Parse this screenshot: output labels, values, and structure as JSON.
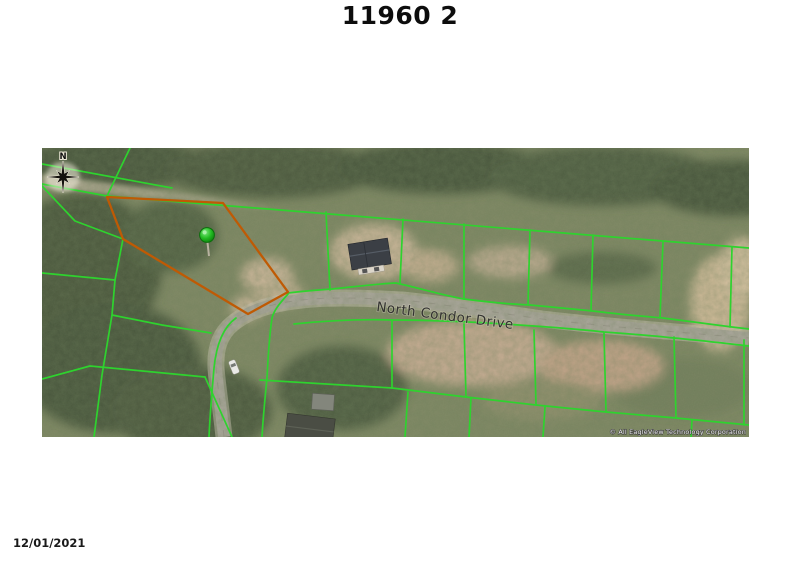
{
  "page": {
    "title": "11960 2",
    "date": "12/01/2021"
  },
  "map": {
    "street_label": "North Condor Drive",
    "compass_label": "N",
    "copyright": "© All EagleView Technology Corporation",
    "marker": "subject-property-pin",
    "colors": {
      "parcel_line": "#2ed32e",
      "highlight_line": "#bf5a04",
      "pin_green": "#1db21d",
      "road_gray": "#a9a59a",
      "trees_base": "#7d8662",
      "trees_dark": "#46543a",
      "sand": "#c6b295"
    }
  }
}
